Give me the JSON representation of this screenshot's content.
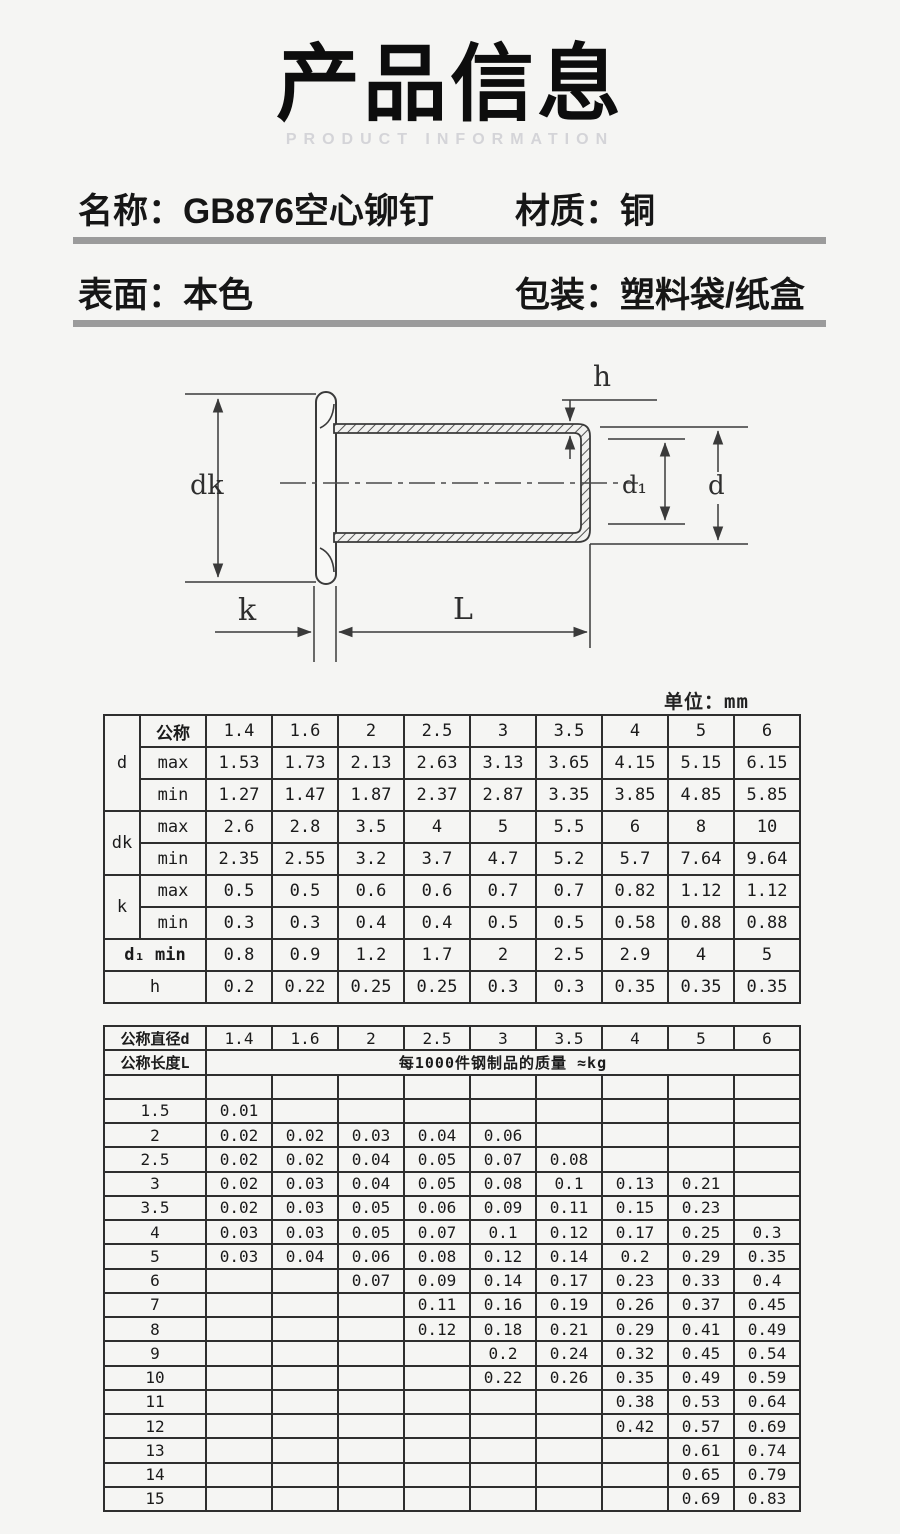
{
  "header": {
    "title": "产品信息",
    "subtitle": "PRODUCT INFORMATION"
  },
  "info": {
    "name_label": "名称：",
    "name_value": "GB876空心铆钉",
    "material_label": "材质：",
    "material_value": "铜",
    "surface_label": "表面：",
    "surface_value": "本色",
    "packaging_label": "包装：",
    "packaging_value": "塑料袋/纸盒"
  },
  "diagram": {
    "labels": {
      "dk": "dk",
      "k": "k",
      "L": "L",
      "h": "h",
      "d1": "d₁",
      "d": "d"
    }
  },
  "dim_table": {
    "unit_label": "单位：mm",
    "groups": [
      {
        "head": "d",
        "rows": [
          {
            "sub": "公称",
            "values": [
              "1.4",
              "1.6",
              "2",
              "2.5",
              "3",
              "3.5",
              "4",
              "5",
              "6"
            ]
          },
          {
            "sub": "max",
            "values": [
              "1.53",
              "1.73",
              "2.13",
              "2.63",
              "3.13",
              "3.65",
              "4.15",
              "5.15",
              "6.15"
            ]
          },
          {
            "sub": "min",
            "values": [
              "1.27",
              "1.47",
              "1.87",
              "2.37",
              "2.87",
              "3.35",
              "3.85",
              "4.85",
              "5.85"
            ]
          }
        ]
      },
      {
        "head": "dk",
        "rows": [
          {
            "sub": "max",
            "values": [
              "2.6",
              "2.8",
              "3.5",
              "4",
              "5",
              "5.5",
              "6",
              "8",
              "10"
            ]
          },
          {
            "sub": "min",
            "values": [
              "2.35",
              "2.55",
              "3.2",
              "3.7",
              "4.7",
              "5.2",
              "5.7",
              "7.64",
              "9.64"
            ]
          }
        ]
      },
      {
        "head": "k",
        "rows": [
          {
            "sub": "max",
            "values": [
              "0.5",
              "0.5",
              "0.6",
              "0.6",
              "0.7",
              "0.7",
              "0.82",
              "1.12",
              "1.12"
            ]
          },
          {
            "sub": "min",
            "values": [
              "0.3",
              "0.3",
              "0.4",
              "0.4",
              "0.5",
              "0.5",
              "0.58",
              "0.88",
              "0.88"
            ]
          }
        ]
      },
      {
        "head": "d₁",
        "sub_in_head": true,
        "rows": [
          {
            "sub": "min",
            "values": [
              "0.8",
              "0.9",
              "1.2",
              "1.7",
              "2",
              "2.5",
              "2.9",
              "4",
              "5"
            ]
          }
        ]
      },
      {
        "head": "h",
        "merged": true,
        "rows": [
          {
            "values": [
              "0.2",
              "0.22",
              "0.25",
              "0.25",
              "0.3",
              "0.3",
              "0.35",
              "0.35",
              "0.35"
            ]
          }
        ]
      }
    ]
  },
  "weight_table": {
    "diameter_label": "公称直径d",
    "length_label": "公称长度L",
    "span_label": "每1000件钢制品的质量 ≈kg",
    "diameters": [
      "1.4",
      "1.6",
      "2",
      "2.5",
      "3",
      "3.5",
      "4",
      "5",
      "6"
    ],
    "rows": [
      {
        "length": "",
        "values": [
          "",
          "",
          "",
          "",
          "",
          "",
          "",
          "",
          ""
        ]
      },
      {
        "length": "1.5",
        "values": [
          "0.01",
          "",
          "",
          "",
          "",
          "",
          "",
          "",
          ""
        ]
      },
      {
        "length": "2",
        "values": [
          "0.02",
          "0.02",
          "0.03",
          "0.04",
          "0.06",
          "",
          "",
          "",
          ""
        ]
      },
      {
        "length": "2.5",
        "values": [
          "0.02",
          "0.02",
          "0.04",
          "0.05",
          "0.07",
          "0.08",
          "",
          "",
          ""
        ]
      },
      {
        "length": "3",
        "values": [
          "0.02",
          "0.03",
          "0.04",
          "0.05",
          "0.08",
          "0.1",
          "0.13",
          "0.21",
          ""
        ]
      },
      {
        "length": "3.5",
        "values": [
          "0.02",
          "0.03",
          "0.05",
          "0.06",
          "0.09",
          "0.11",
          "0.15",
          "0.23",
          ""
        ]
      },
      {
        "length": "4",
        "values": [
          "0.03",
          "0.03",
          "0.05",
          "0.07",
          "0.1",
          "0.12",
          "0.17",
          "0.25",
          "0.3"
        ]
      },
      {
        "length": "5",
        "values": [
          "0.03",
          "0.04",
          "0.06",
          "0.08",
          "0.12",
          "0.14",
          "0.2",
          "0.29",
          "0.35"
        ]
      },
      {
        "length": "6",
        "values": [
          "",
          "",
          "0.07",
          "0.09",
          "0.14",
          "0.17",
          "0.23",
          "0.33",
          "0.4"
        ]
      },
      {
        "length": "7",
        "values": [
          "",
          "",
          "",
          "0.11",
          "0.16",
          "0.19",
          "0.26",
          "0.37",
          "0.45"
        ]
      },
      {
        "length": "8",
        "values": [
          "",
          "",
          "",
          "0.12",
          "0.18",
          "0.21",
          "0.29",
          "0.41",
          "0.49"
        ]
      },
      {
        "length": "9",
        "values": [
          "",
          "",
          "",
          "",
          "0.2",
          "0.24",
          "0.32",
          "0.45",
          "0.54"
        ]
      },
      {
        "length": "10",
        "values": [
          "",
          "",
          "",
          "",
          "0.22",
          "0.26",
          "0.35",
          "0.49",
          "0.59"
        ]
      },
      {
        "length": "11",
        "values": [
          "",
          "",
          "",
          "",
          "",
          "",
          "0.38",
          "0.53",
          "0.64"
        ]
      },
      {
        "length": "12",
        "values": [
          "",
          "",
          "",
          "",
          "",
          "",
          "0.42",
          "0.57",
          "0.69"
        ]
      },
      {
        "length": "13",
        "values": [
          "",
          "",
          "",
          "",
          "",
          "",
          "",
          "0.61",
          "0.74"
        ]
      },
      {
        "length": "14",
        "values": [
          "",
          "",
          "",
          "",
          "",
          "",
          "",
          "0.65",
          "0.79"
        ]
      },
      {
        "length": "15",
        "values": [
          "",
          "",
          "",
          "",
          "",
          "",
          "",
          "0.69",
          "0.83"
        ]
      }
    ]
  },
  "colors": {
    "background": "#f5f5f3",
    "divider": "#9b9b9b",
    "subtitle": "#d4d4d8",
    "drawing_line": "#3a3a3a",
    "table_border": "#2e2e2e"
  }
}
